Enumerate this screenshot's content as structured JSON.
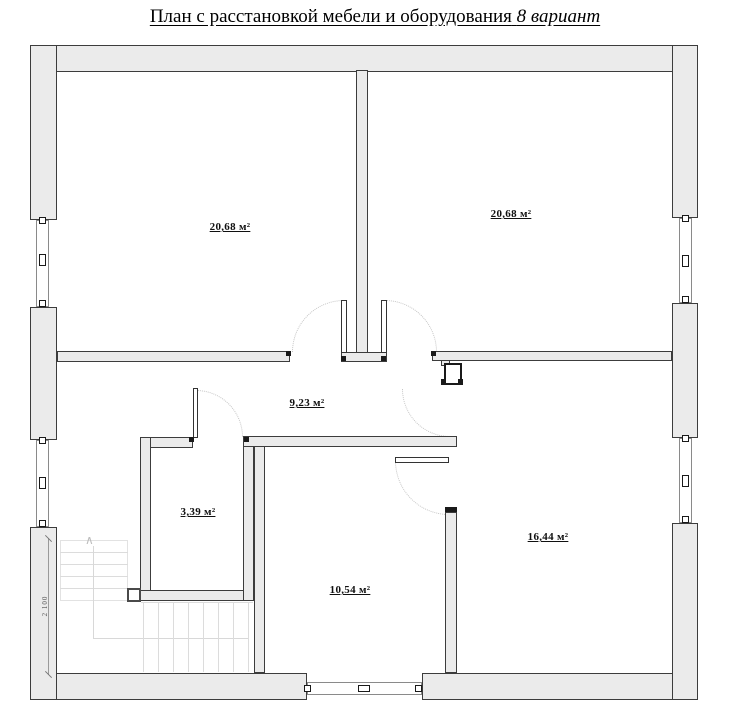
{
  "title": {
    "main": "План с расстановкой мебели и оборудования",
    "variant": "8 вариант"
  },
  "rooms": [
    {
      "id": "room-top-left",
      "area": "20,68 м²"
    },
    {
      "id": "room-top-right",
      "area": "20,68 м²"
    },
    {
      "id": "hallway",
      "area": "9,23 м²"
    },
    {
      "id": "closet",
      "area": "3,39 м²"
    },
    {
      "id": "room-bottom",
      "area": "10,54 м²"
    },
    {
      "id": "room-right",
      "area": "16,44 м²"
    }
  ],
  "dimensions": {
    "stair_width": "2 100"
  },
  "icons": {
    "stairs_up_arrow": "∧"
  },
  "colors": {
    "wall_fill": "#ebebeb",
    "wall_line": "#3c3c3c",
    "door_arc": "#c4c4c4",
    "stair_line": "#dcdcdc"
  }
}
